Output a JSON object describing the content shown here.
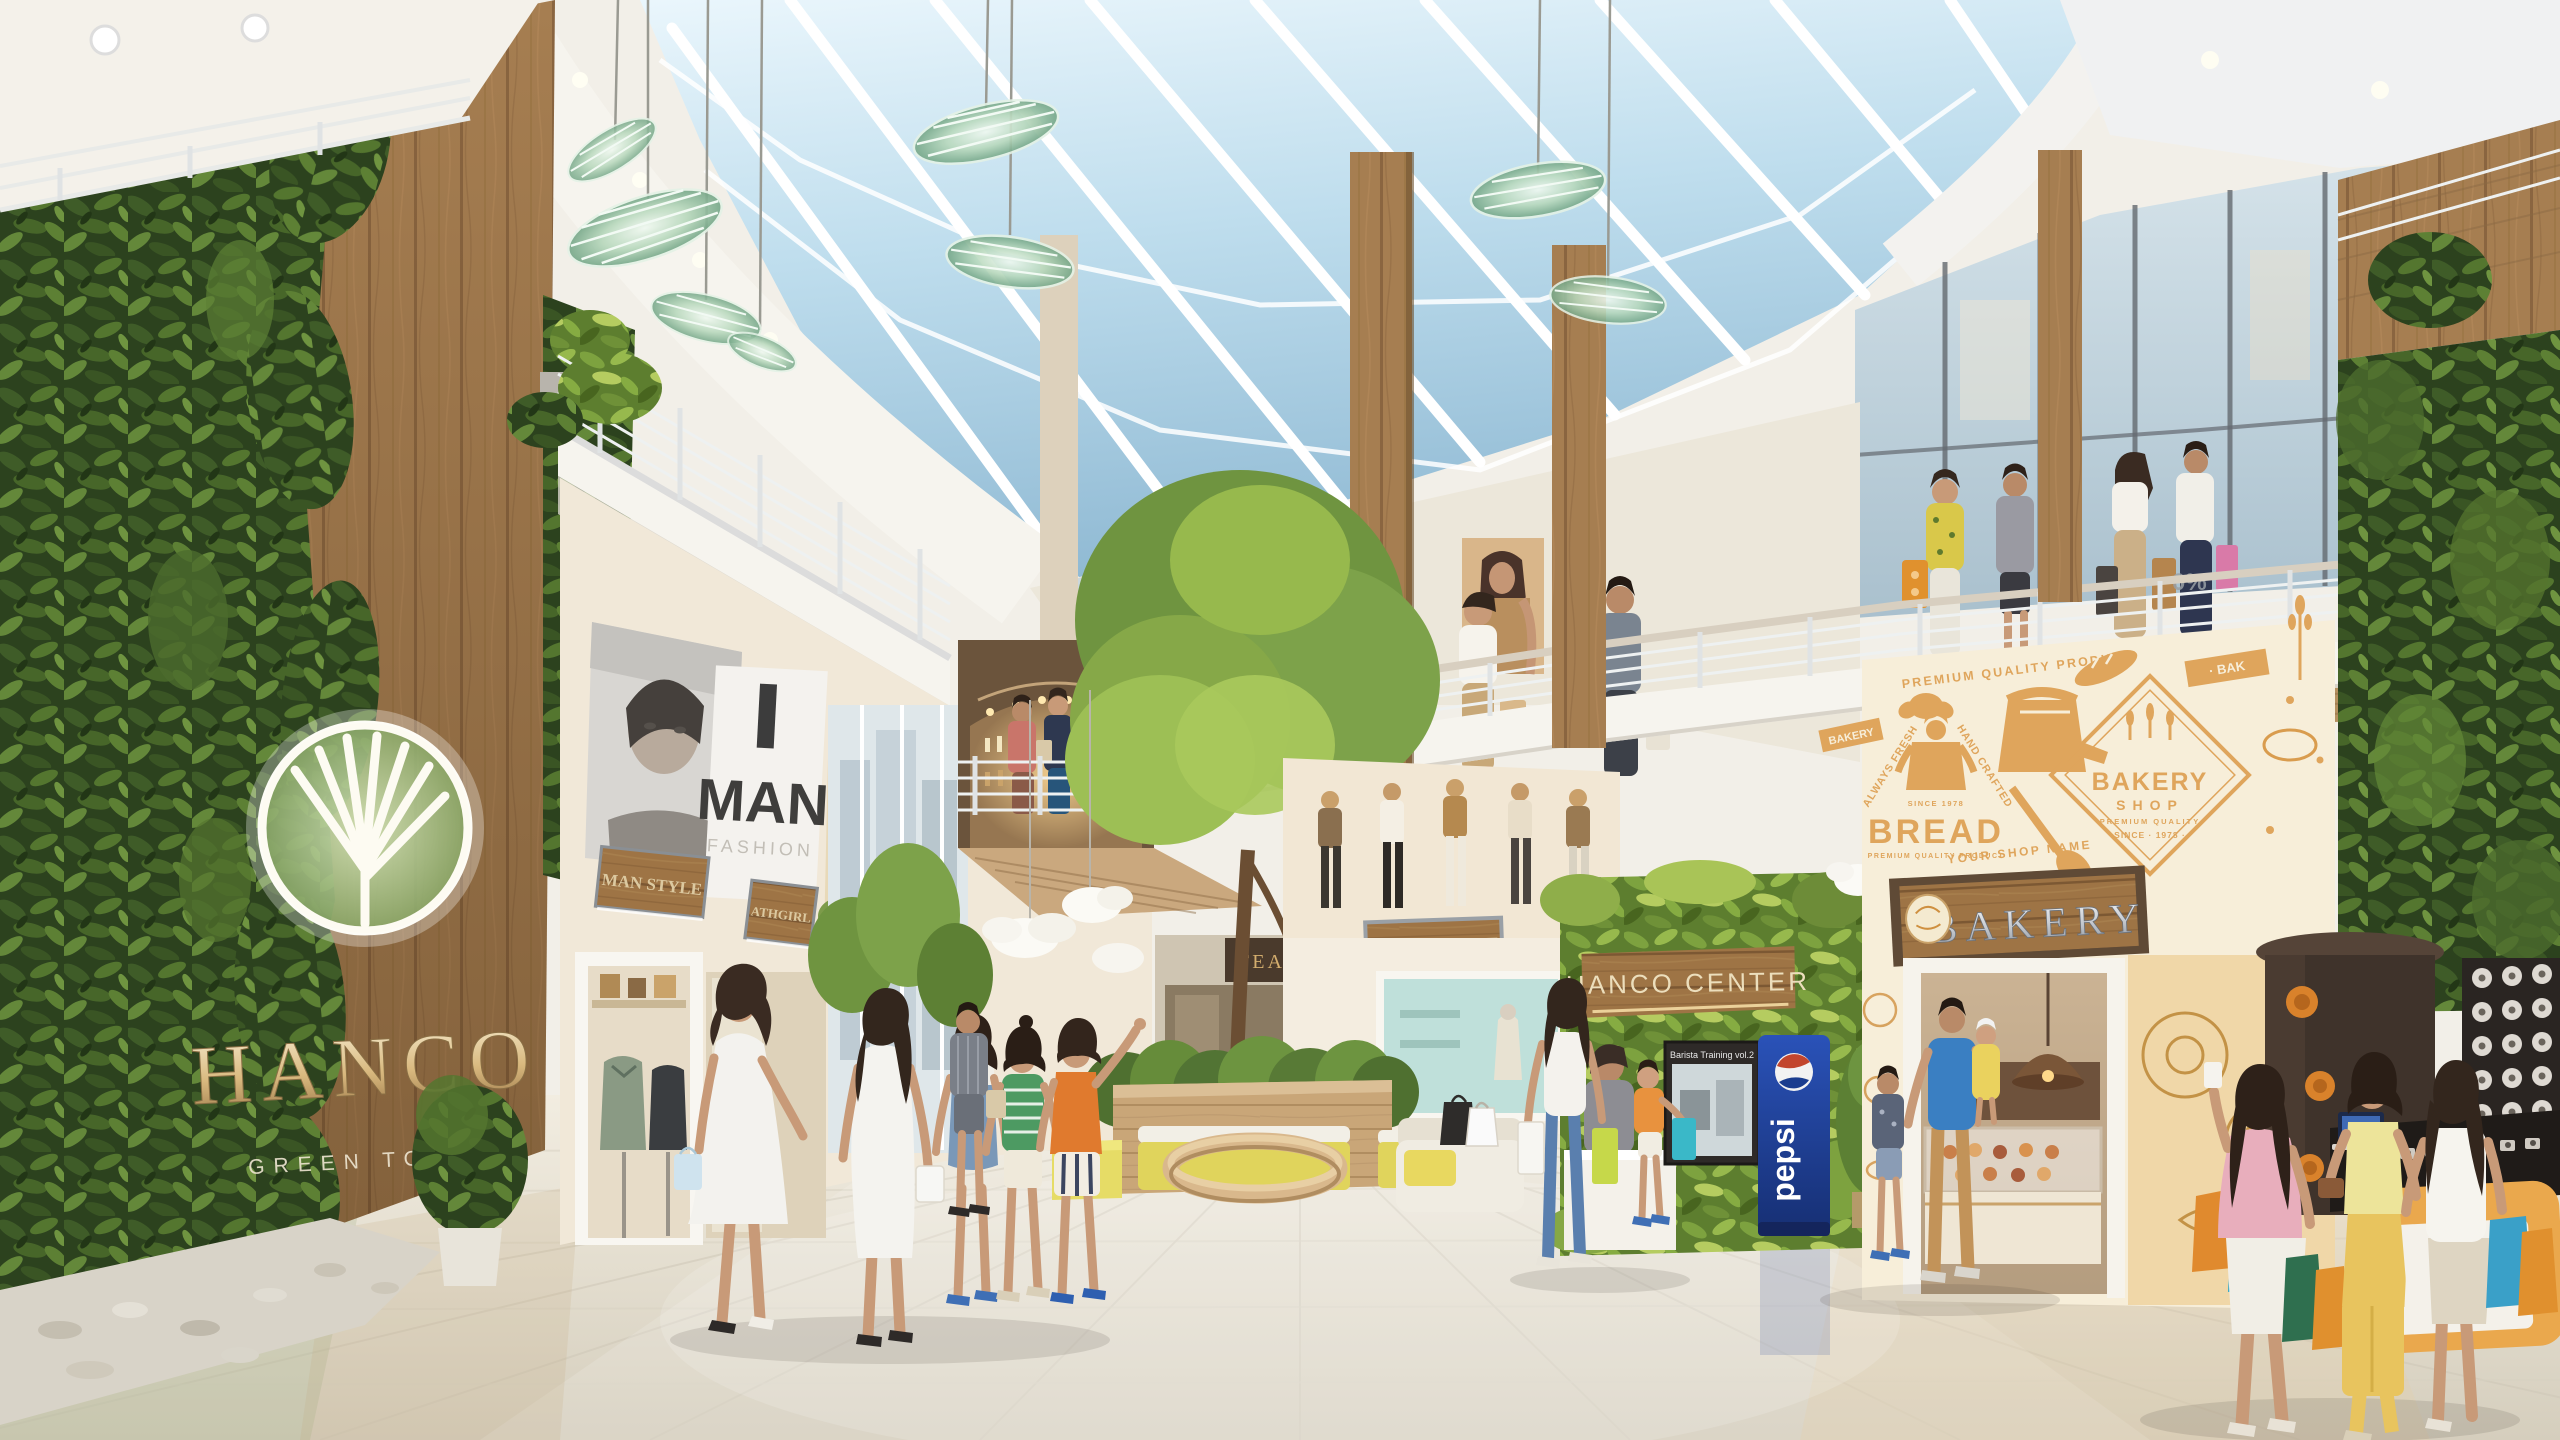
{
  "meta": {
    "scene_title": "HANCO GREEN TOWN — shopping mall atrium interior rendering"
  },
  "branding": {
    "wall_logo_text": "HANCO",
    "wall_logo_tagline": "GREEN TOWN",
    "center_sign": "HANCO CENTER"
  },
  "storefronts": {
    "man_poster": {
      "line1": "MAN",
      "line2": "FASHION"
    },
    "left_signs": [
      "MAN STYLE",
      "ATHGIRL",
      "DINING"
    ],
    "tea_sign": "TEA",
    "achi_style_sign": "ACHI STYLE",
    "bakery_sign": "BAKERY"
  },
  "bakery_mural": {
    "arc_top": "PREMIUM QUALITY PRODUCT",
    "ribbon_left": "BAKERY",
    "ribbon_right": "· BAK",
    "bread_arc_left": "ALWAYS FRESH",
    "bread_arc_right": "HAND CRAFTED",
    "bread_since": "SINCE 1978",
    "bread_title": "BREAD",
    "bread_sub": "PREMIUM QUALITY PRODUCT",
    "shop_title": "BAKERY",
    "shop_sub": "SHOP",
    "shop_quality": "PREMIUM QUALITY",
    "shop_since": "SINCE · 1978 ·",
    "arc_bottom": "YOUR SHOP NAME"
  },
  "displays": {
    "pepsi_machine": "pepsi",
    "screen_caption": "Barista Training vol.2",
    "balcony_sale_tag": "0%"
  },
  "colors": {
    "sky": "#b9d8e8",
    "ceiling": "#f3f0ea",
    "wall_cream": "#f3ebdc",
    "wood": "#a57e52",
    "foliage_dark": "#33491f",
    "foliage_bright": "#7da23f",
    "bakery_mural_orange": "#dfa55c",
    "pepsi_blue": "#1e3e94",
    "bench_yellow": "#e3d75f",
    "floor": "#eae3d4"
  }
}
